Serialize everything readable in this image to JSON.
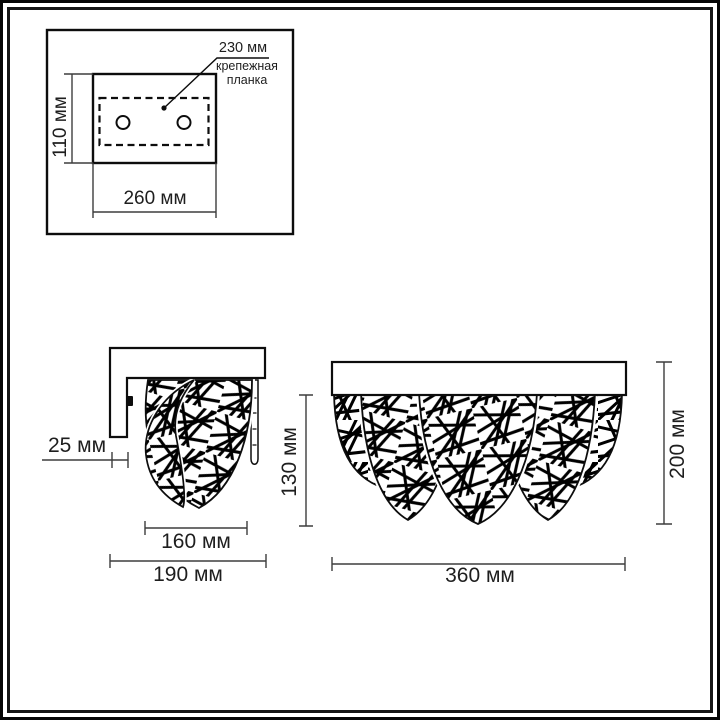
{
  "inset_top_view": {
    "hole_spacing_label": "230 мм",
    "plate_caption_line1": "крепежная",
    "plate_caption_line2": "планка",
    "height_label": "110 мм",
    "width_label": "260 мм"
  },
  "side_view": {
    "wall_offset_label": "25 мм",
    "shade_width_label": "160 мм",
    "total_depth_label": "190 мм",
    "shade_height_label": "130 мм"
  },
  "front_view": {
    "total_height_label": "200 мм",
    "total_width_label": "360 мм"
  },
  "colors": {
    "ink": "#0d0d0d",
    "dimension_line": "#3d3d3d",
    "background": "#ffffff"
  }
}
